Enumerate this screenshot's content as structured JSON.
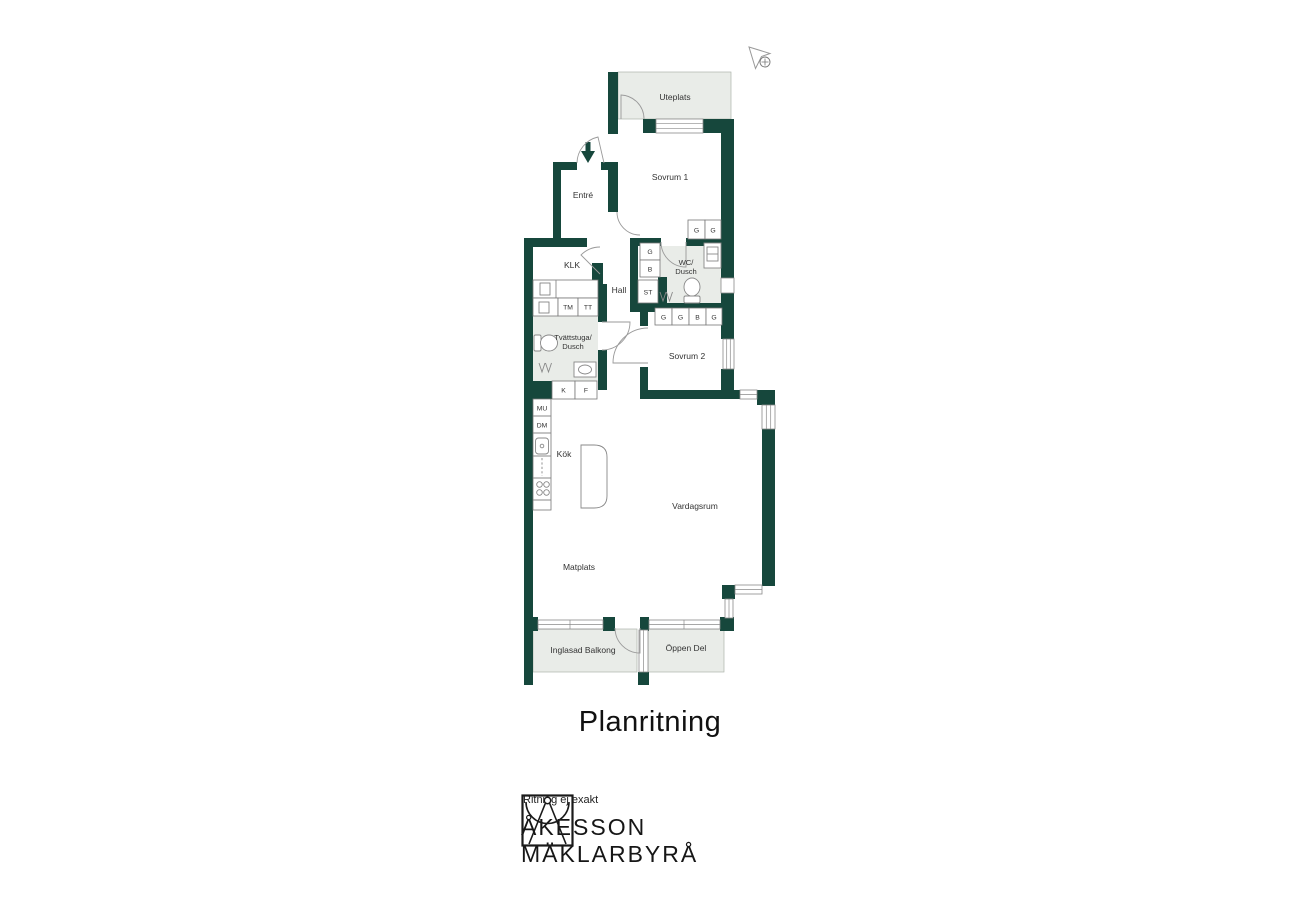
{
  "title": "Planritning",
  "footer": {
    "disclaimer": "Ritning ej exakt",
    "brand_line1": "ÅKESSON",
    "brand_line2": "MÄKLARBYRÅ"
  },
  "colors": {
    "wall": "#16473c",
    "room_fill": "#e9ece8",
    "line": "#999999",
    "text": "#333333"
  },
  "plan": {
    "icons": {
      "north": "north-compass-arrow",
      "entry": "entry-direction-arrow"
    },
    "rooms": {
      "uteplats": "Uteplats",
      "sovrum1": "Sovrum 1",
      "entre": "Entré",
      "klk": "KLK",
      "hall": "Hall",
      "wc1": "WC/",
      "wc2": "Dusch",
      "tvatt1": "Tvättstuga/",
      "tvatt2": "Dusch",
      "sovrum2": "Sovrum 2",
      "kok": "Kök",
      "vardagsrum": "Vardagsrum",
      "matplats": "Matplats",
      "balkong": "Inglasad Balkong",
      "oppendel": "Öppen Del"
    },
    "cabinets": {
      "g": "G",
      "b": "B",
      "st": "ST",
      "tm": "TM",
      "tt": "TT",
      "k": "K",
      "f": "F",
      "mu": "MU",
      "dm": "DM"
    }
  }
}
